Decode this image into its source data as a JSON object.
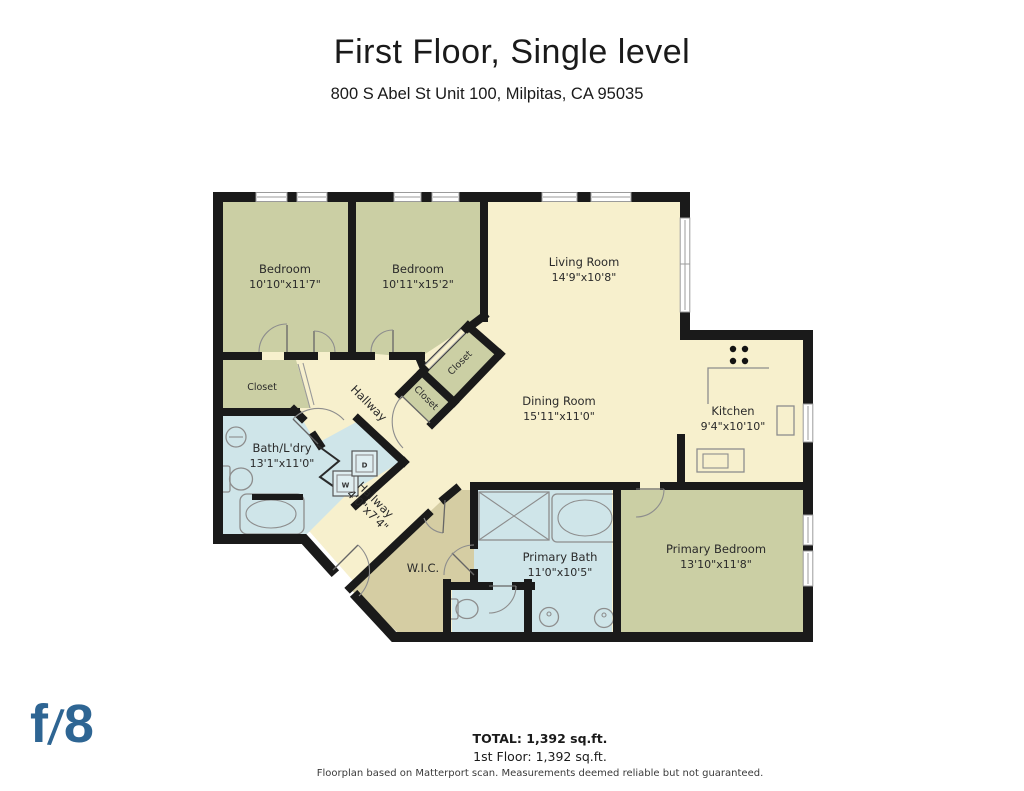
{
  "header": {
    "title": "First Floor, Single level",
    "address": "800 S Abel St Unit 100, Milpitas, CA 95035"
  },
  "rooms": {
    "bedroom1": {
      "name": "Bedroom",
      "dims": "10'10\"x11'7\""
    },
    "bedroom2": {
      "name": "Bedroom",
      "dims": "10'11\"x15'2\""
    },
    "living": {
      "name": "Living Room",
      "dims": "14'9\"x10'8\""
    },
    "dining": {
      "name": "Dining Room",
      "dims": "15'11\"x11'0\""
    },
    "kitchen": {
      "name": "Kitchen",
      "dims": "9'4\"x10'10\""
    },
    "bath_laundry": {
      "name": "Bath/L'dry",
      "dims": "13'1\"x11'0\""
    },
    "hallway_main": {
      "name": "Hallway"
    },
    "hallway_small": {
      "name": "Hallway",
      "dims": "4'0\"x7'4\""
    },
    "wic": {
      "name": "W.I.C."
    },
    "primary_bath": {
      "name": "Primary Bath",
      "dims": "11'0\"x10'5\""
    },
    "primary_bedroom": {
      "name": "Primary Bedroom",
      "dims": "13'10\"x11'8\""
    },
    "closet_bedroom1": {
      "name": "Closet"
    },
    "closet_bedroom2": {
      "name": "Closet"
    },
    "closet_hall": {
      "name": "Closet"
    },
    "washer": {
      "label": "W"
    },
    "dryer": {
      "label": "D"
    }
  },
  "footer": {
    "total": "TOTAL: 1,392 sq.ft.",
    "floor": "1st Floor: 1,392 sq.ft.",
    "disclaimer": "Floorplan based on Matterport scan. Measurements deemed reliable but not guaranteed."
  },
  "logo": {
    "f": "f",
    "slash": "/",
    "eight": "8"
  },
  "colors": {
    "wall": "#1a1a1a",
    "floor_cream": "#f7f0cd",
    "floor_olive": "#cbcfa4",
    "floor_tan": "#d5cda3",
    "floor_blue": "#cfe5e9",
    "appliance_blue": "#dfeef1",
    "logo_blue": "#2e6593"
  }
}
